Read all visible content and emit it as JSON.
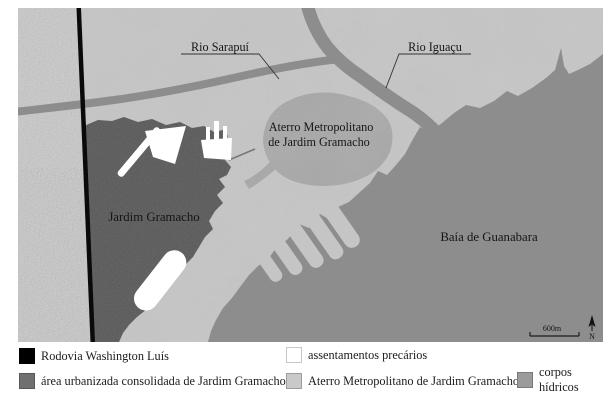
{
  "map": {
    "labels": {
      "rio_sarapui": "Rio Sarapuí",
      "rio_iguacu": "Rio Iguaçu",
      "aterro_line1": "Aterro Metropolitano",
      "aterro_line2": "de Jardim Gramacho",
      "jardim_gramacho": "Jardim Gramacho",
      "baia_de_guanabara": "Baía de Guanabara"
    },
    "scale_bar": {
      "label": "600m"
    },
    "north_arrow": {
      "label": "N"
    }
  },
  "colors": {
    "land": "#c5c5c5",
    "satellite_strip": "#cacaca",
    "water": "#8d8d8d",
    "landfill": "#a9a9a9",
    "urban_area": "#595959",
    "road": "#0a0a0a",
    "settlement": "#ffffff"
  },
  "legend": {
    "items": [
      {
        "label": "Rodovia Washington Luís",
        "swatch": "#000000"
      },
      {
        "label": "área urbanizada consolidada de Jardim Gramacho",
        "swatch": "#707070"
      },
      {
        "label": "assentamentos precários",
        "swatch": "#ffffff"
      },
      {
        "label": "Aterro Metropolitano de Jardim Gramacho",
        "swatch": "#c9c9c9"
      },
      {
        "label": "corpos hídricos",
        "swatch": "#9b9b9b"
      }
    ]
  }
}
